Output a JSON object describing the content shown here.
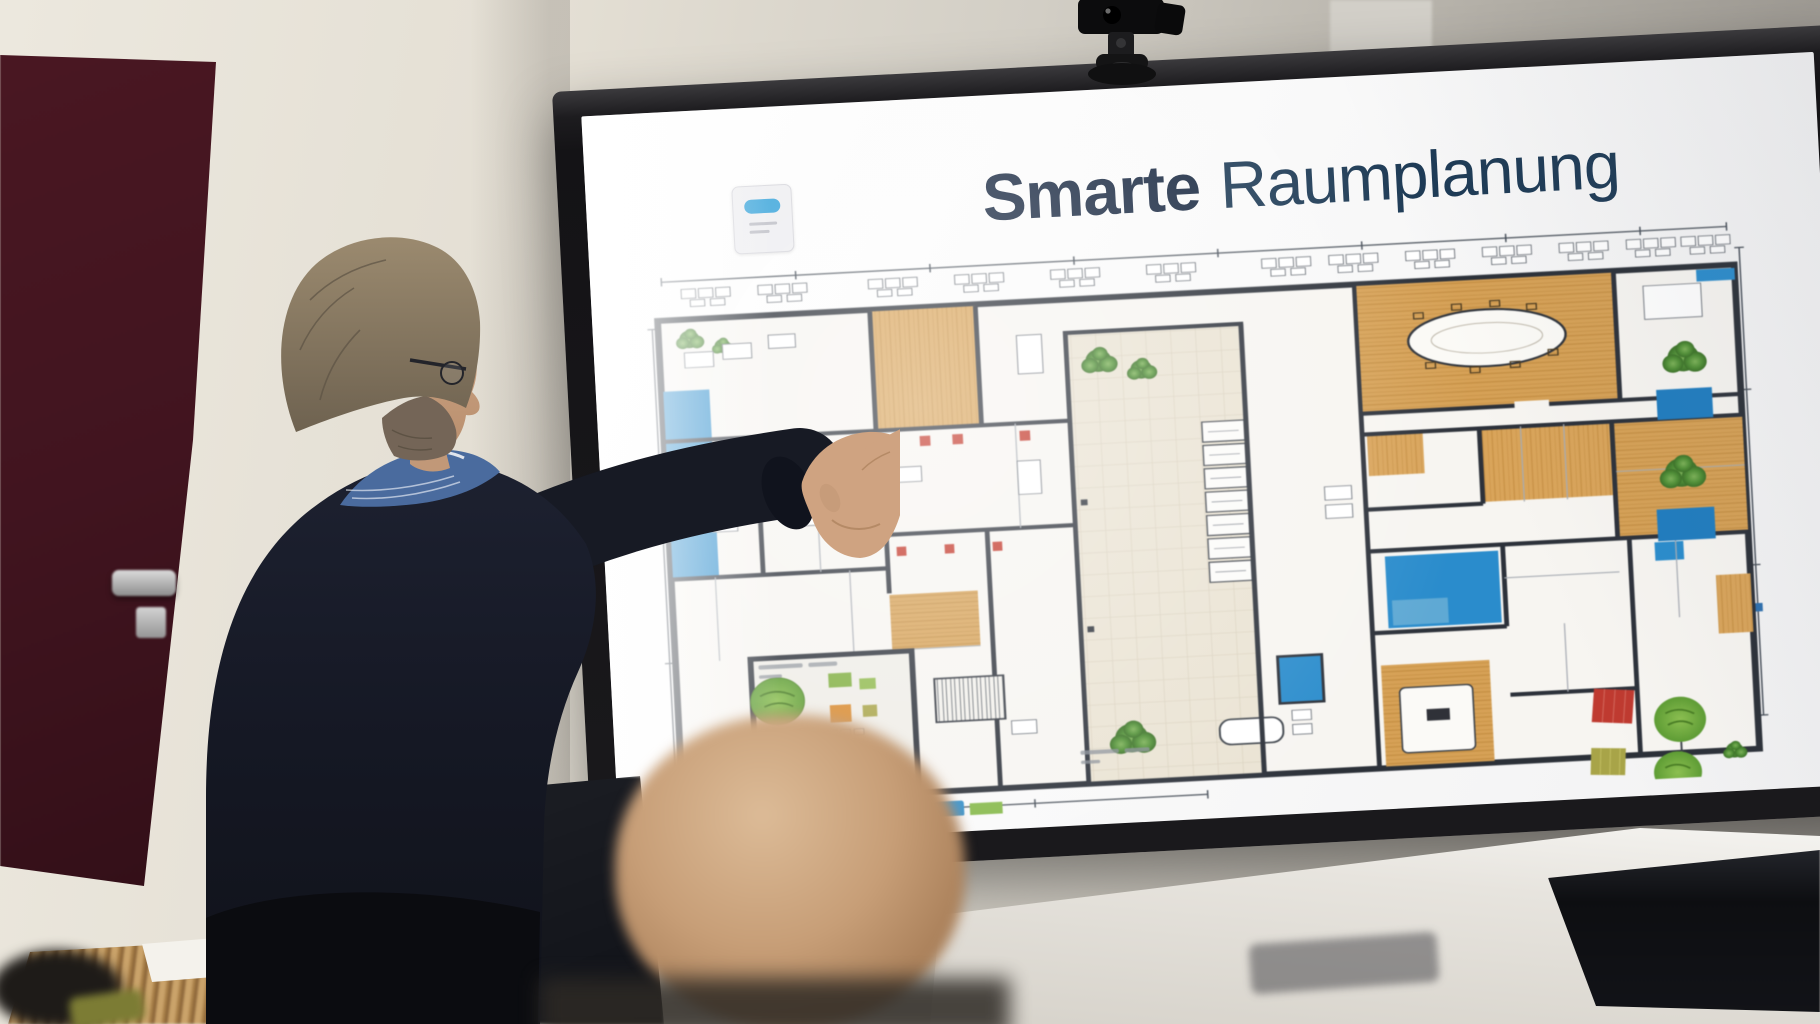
{
  "screen": {
    "title": {
      "bold": "Smarte",
      "regular": "Raumplanung"
    },
    "title_colors": {
      "bold": "#16263f",
      "regular": "#1d3a55"
    },
    "logo": {
      "name": "slide-logo-badge",
      "pill_color": "#2e9fd8",
      "card_color": "#ededf0"
    }
  },
  "floor_plan": {
    "type": "office-floor-plan",
    "palette": {
      "walls": "#2b3038",
      "wood_floor": "#d9a45a",
      "atrium_tile": "#eae3d3",
      "accent_blue": "#2a8ccc",
      "water_blue": "#1f7cbf",
      "tree_green": "#4f8f35",
      "lawn_green": "#6fae3f",
      "chair_red": "#c23527",
      "tile_red": "#bf3a30",
      "tile_olive": "#a8a448",
      "dimension_lines": "#454d57"
    },
    "features": [
      "dimension lines",
      "perimeter desk rows",
      "tiled atrium with trees",
      "conference room with oval table",
      "wood-floor offices",
      "blue meeting rooms",
      "inner courtyard with lawn",
      "stairs",
      "planters with trees",
      "lounge furniture"
    ]
  },
  "environment": {
    "door_color": "#41141f",
    "wall_color": "#d8d4cb",
    "screen_bezel_color": "#1c1b1d",
    "webcam": "ptz-camera-on-top-of-display"
  }
}
